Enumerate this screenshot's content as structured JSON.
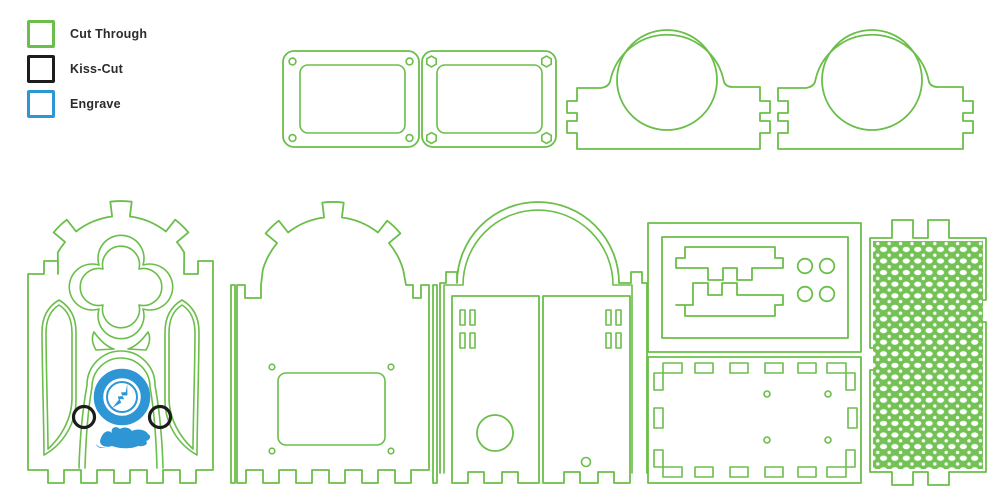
{
  "colors": {
    "cut_through": "#6bbe4a",
    "kiss_cut": "#1c1c1c",
    "engrave": "#2e96d5",
    "mesh_fill": "#74c255",
    "background": "#ffffff"
  },
  "legend": {
    "items": [
      {
        "id": "cut-through",
        "label": "Cut Through"
      },
      {
        "id": "kiss-cut",
        "label": "Kiss-Cut"
      },
      {
        "id": "engrave",
        "label": "Engrave"
      }
    ]
  },
  "canvas": {
    "parts": [
      {
        "id": "lid-frame-round-holes",
        "layer": "cut"
      },
      {
        "id": "lid-frame-hex-holes",
        "layer": "cut"
      },
      {
        "id": "arch-bracket-a",
        "layer": "cut"
      },
      {
        "id": "arch-bracket-b",
        "layer": "cut"
      },
      {
        "id": "gothic-facade-panel",
        "layer": "cut+kiss+engrave"
      },
      {
        "id": "back-arch-panel",
        "layer": "cut"
      },
      {
        "id": "door-panel",
        "layer": "cut"
      },
      {
        "id": "interlock-tray",
        "layer": "cut"
      },
      {
        "id": "slotted-base-plate",
        "layer": "cut"
      },
      {
        "id": "flex-mesh-panel",
        "layer": "cut"
      }
    ]
  }
}
